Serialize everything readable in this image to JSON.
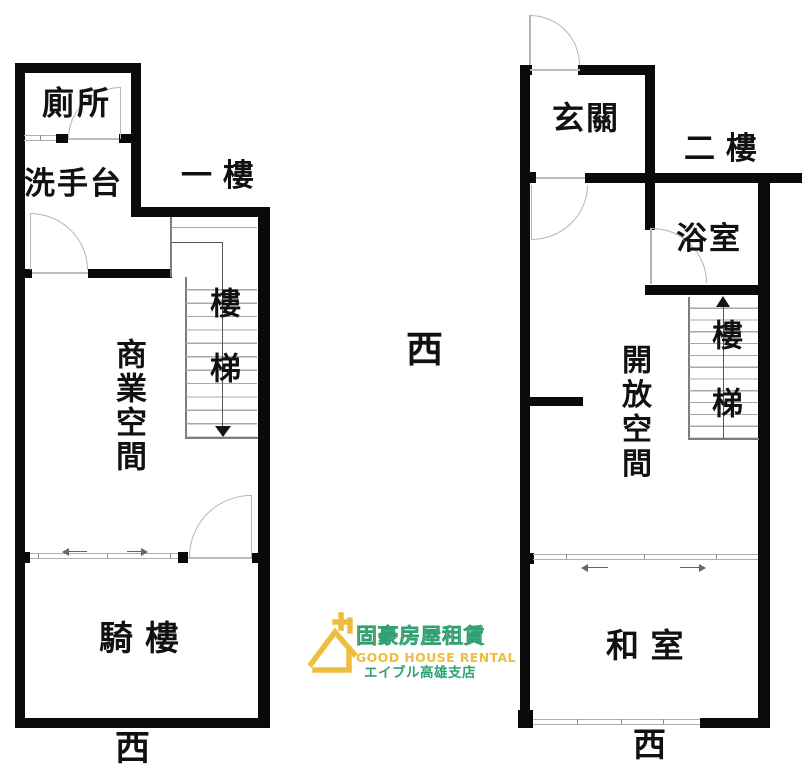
{
  "floor1": {
    "title": "一 樓",
    "toilet": "廁所",
    "washbasin": "洗手台",
    "commercial_space": "商業空間",
    "stairs": "樓梯",
    "arcade": "騎 樓",
    "compass": "西"
  },
  "floor2": {
    "title": "二 樓",
    "entrance": "玄關",
    "bathroom": "浴室",
    "open_space": "開放空間",
    "stairs": "樓梯",
    "tatami_room": "和 室",
    "compass": "西"
  },
  "center_compass": "西",
  "logo": {
    "name_zh": "固豪房屋租賃",
    "name_en": "GOOD HOUSE RENTAL",
    "branch_jp": "エイブル高雄支店",
    "accent_yellow": "#EDBE3D",
    "accent_green": "#2FA174"
  }
}
